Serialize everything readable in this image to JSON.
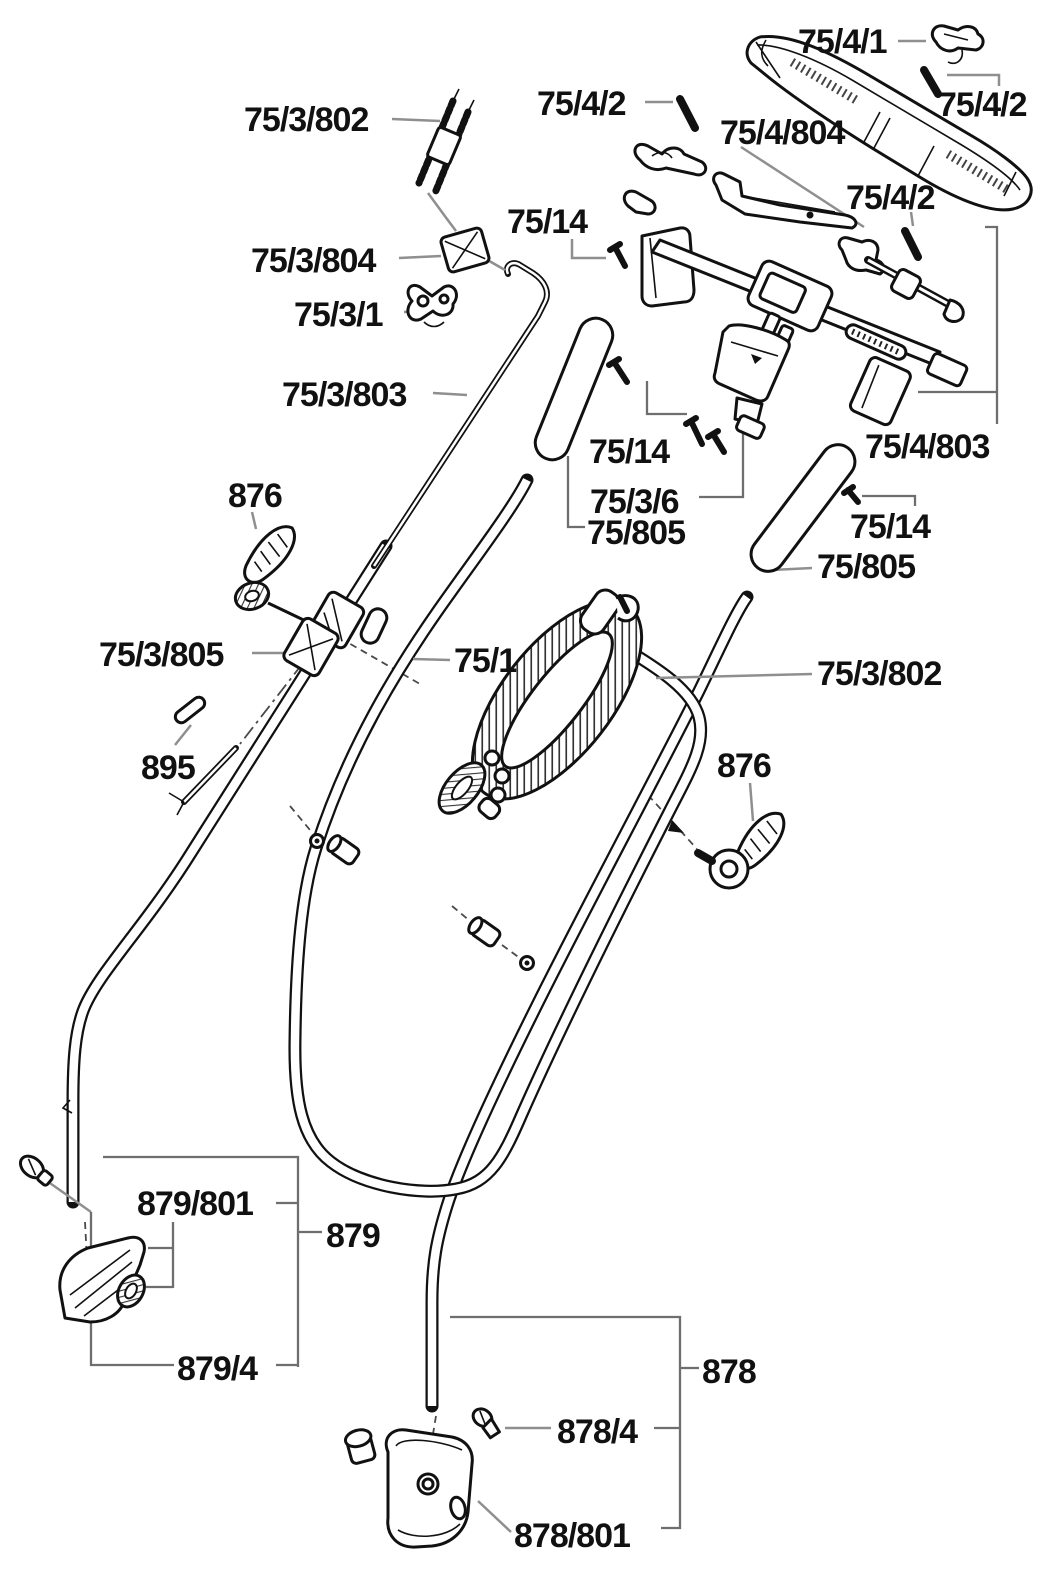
{
  "diagram": {
    "type": "exploded-parts-diagram",
    "subject": "lawn mower handle assembly exploded view",
    "background_color": "#ffffff",
    "ink_color": "#111111",
    "leader_color": "#8f8f8f"
  },
  "labels": {
    "p_75_4_1": "75/4/1",
    "p_75_4_2_right": "75/4/2",
    "p_75_4_2_left": "75/4/2",
    "p_75_4_2_mid": "75/4/2",
    "p_75_4_804": "75/4/804",
    "p_75_4_803": "75/4/803",
    "p_75_14_top": "75/14",
    "p_75_14_midleft": "75/14",
    "p_75_14_right": "75/14",
    "p_75_3_802_tl": "75/3/802",
    "p_75_3_802_right": "75/3/802",
    "p_75_3_803": "75/3/803",
    "p_75_3_804": "75/3/804",
    "p_75_3_805": "75/3/805",
    "p_75_3_1": "75/3/1",
    "p_75_3_6": "75/3/6",
    "p_75_805_left": "75/805",
    "p_75_805_right": "75/805",
    "p_75_1": "75/1",
    "p_876_left": "876",
    "p_876_right": "876",
    "p_895": "895",
    "p_879_801": "879/801",
    "p_879": "879",
    "p_879_4": "879/4",
    "p_878": "878",
    "p_878_4": "878/4",
    "p_878_801": "878/801"
  }
}
